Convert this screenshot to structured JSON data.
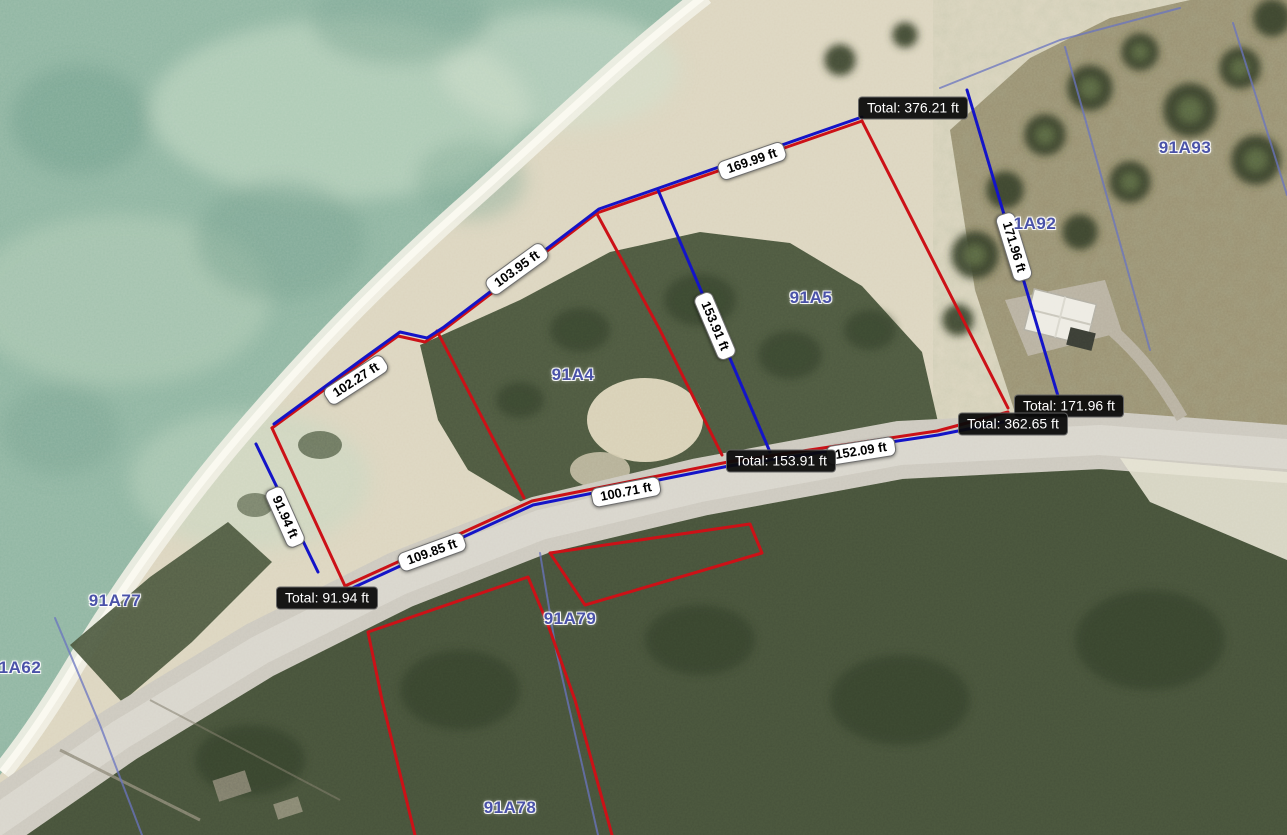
{
  "map": {
    "colors": {
      "sea": "#8fb5a2",
      "sea_shallow": "#c8dcc6",
      "sand": "#dcd5bf",
      "surf": "#f1f0e4",
      "vegetation": "#4d5840",
      "scrub_brown": "#988e70",
      "road": "#ccc8be",
      "measure_red": "#cc1117",
      "measure_blue": "#1414c8",
      "cadastral_blue": "#6a74c0",
      "parcel_label_text": "#4a52a8",
      "total_label_bg": "#0a0a0a",
      "total_label_text": "#ffffff",
      "segment_label_bg": "#ffffff",
      "segment_label_text": "#000000"
    },
    "parcel_labels": [
      {
        "id": "91A93",
        "x": 1185,
        "y": 148
      },
      {
        "id": "1A92",
        "x": 1035,
        "y": 224
      },
      {
        "id": "91A5",
        "x": 811,
        "y": 298
      },
      {
        "id": "91A4",
        "x": 573,
        "y": 375
      },
      {
        "id": "91A77",
        "x": 115,
        "y": 601
      },
      {
        "id": "1A62",
        "x": 20,
        "y": 668
      },
      {
        "id": "91A79",
        "x": 570,
        "y": 619
      },
      {
        "id": "91A78",
        "x": 510,
        "y": 808
      }
    ],
    "segment_labels": [
      {
        "text": "169.99 ft",
        "x": 752,
        "y": 161,
        "angle": -19
      },
      {
        "text": "103.95 ft",
        "x": 517,
        "y": 269,
        "angle": -36
      },
      {
        "text": "102.27 ft",
        "x": 356,
        "y": 380,
        "angle": -33
      },
      {
        "text": "153.91 ft",
        "x": 715,
        "y": 326,
        "angle": 67
      },
      {
        "text": "171.96 ft",
        "x": 1014,
        "y": 247,
        "angle": 73
      },
      {
        "text": "91.94 ft",
        "x": 285,
        "y": 517,
        "angle": 66
      },
      {
        "text": "109.85 ft",
        "x": 432,
        "y": 552,
        "angle": -20
      },
      {
        "text": "100.71 ft",
        "x": 626,
        "y": 492,
        "angle": -11
      },
      {
        "text": "152.09 ft",
        "x": 861,
        "y": 451,
        "angle": -9
      }
    ],
    "total_labels": [
      {
        "text": "Total: 376.21 ft",
        "x": 858,
        "y": 108
      },
      {
        "text": "Total: 171.96 ft",
        "x": 1014,
        "y": 406
      },
      {
        "text": "Total: 362.65 ft",
        "x": 958,
        "y": 424
      },
      {
        "text": "Total: 153.91 ft",
        "x": 726,
        "y": 461
      },
      {
        "text": "Total: 91.94 ft",
        "x": 276,
        "y": 598
      }
    ],
    "measure_lines": {
      "red": [
        [
          [
            272,
            428
          ],
          [
            362,
            362
          ],
          [
            398,
            336
          ],
          [
            425,
            342
          ],
          [
            442,
            331
          ],
          [
            597,
            213
          ],
          [
            862,
            121
          ]
        ],
        [
          [
            272,
            428
          ],
          [
            345,
            586
          ]
        ],
        [
          [
            437,
            331
          ],
          [
            524,
            498
          ]
        ],
        [
          [
            597,
            214
          ],
          [
            660,
            330
          ],
          [
            722,
            455
          ]
        ],
        [
          [
            862,
            121
          ],
          [
            1008,
            408
          ]
        ],
        [
          [
            345,
            586
          ],
          [
            532,
            501
          ],
          [
            728,
            462
          ],
          [
            937,
            431
          ],
          [
            1008,
            412
          ]
        ],
        [
          [
            550,
            553
          ],
          [
            750,
            524
          ],
          [
            762,
            553
          ],
          [
            585,
            605
          ],
          [
            550,
            553
          ]
        ],
        [
          [
            415,
            835
          ],
          [
            382,
            700
          ],
          [
            368,
            632
          ],
          [
            528,
            577
          ],
          [
            548,
            625
          ],
          [
            575,
            700
          ],
          [
            612,
            835
          ]
        ]
      ],
      "blue": [
        [
          [
            274,
            424
          ],
          [
            364,
            358
          ],
          [
            400,
            332
          ],
          [
            427,
            338
          ],
          [
            444,
            327
          ],
          [
            599,
            209
          ],
          [
            862,
            117
          ]
        ],
        [
          [
            256,
            444
          ],
          [
            318,
            572
          ]
        ],
        [
          [
            658,
            190
          ],
          [
            770,
            452
          ]
        ],
        [
          [
            967,
            90
          ],
          [
            1058,
            396
          ]
        ],
        [
          [
            348,
            590
          ],
          [
            533,
            505
          ],
          [
            729,
            466
          ],
          [
            938,
            435
          ],
          [
            1003,
            422
          ]
        ]
      ]
    },
    "cadastral_lines": [
      [
        [
          1065,
          47
        ],
        [
          1150,
          350
        ]
      ],
      [
        [
          1233,
          23
        ],
        [
          1287,
          195
        ]
      ],
      [
        [
          540,
          553
        ],
        [
          556,
          650
        ],
        [
          598,
          835
        ]
      ],
      [
        [
          55,
          618
        ],
        [
          100,
          725
        ],
        [
          142,
          835
        ]
      ],
      [
        [
          940,
          88
        ],
        [
          1060,
          40
        ],
        [
          1180,
          8
        ]
      ]
    ]
  }
}
